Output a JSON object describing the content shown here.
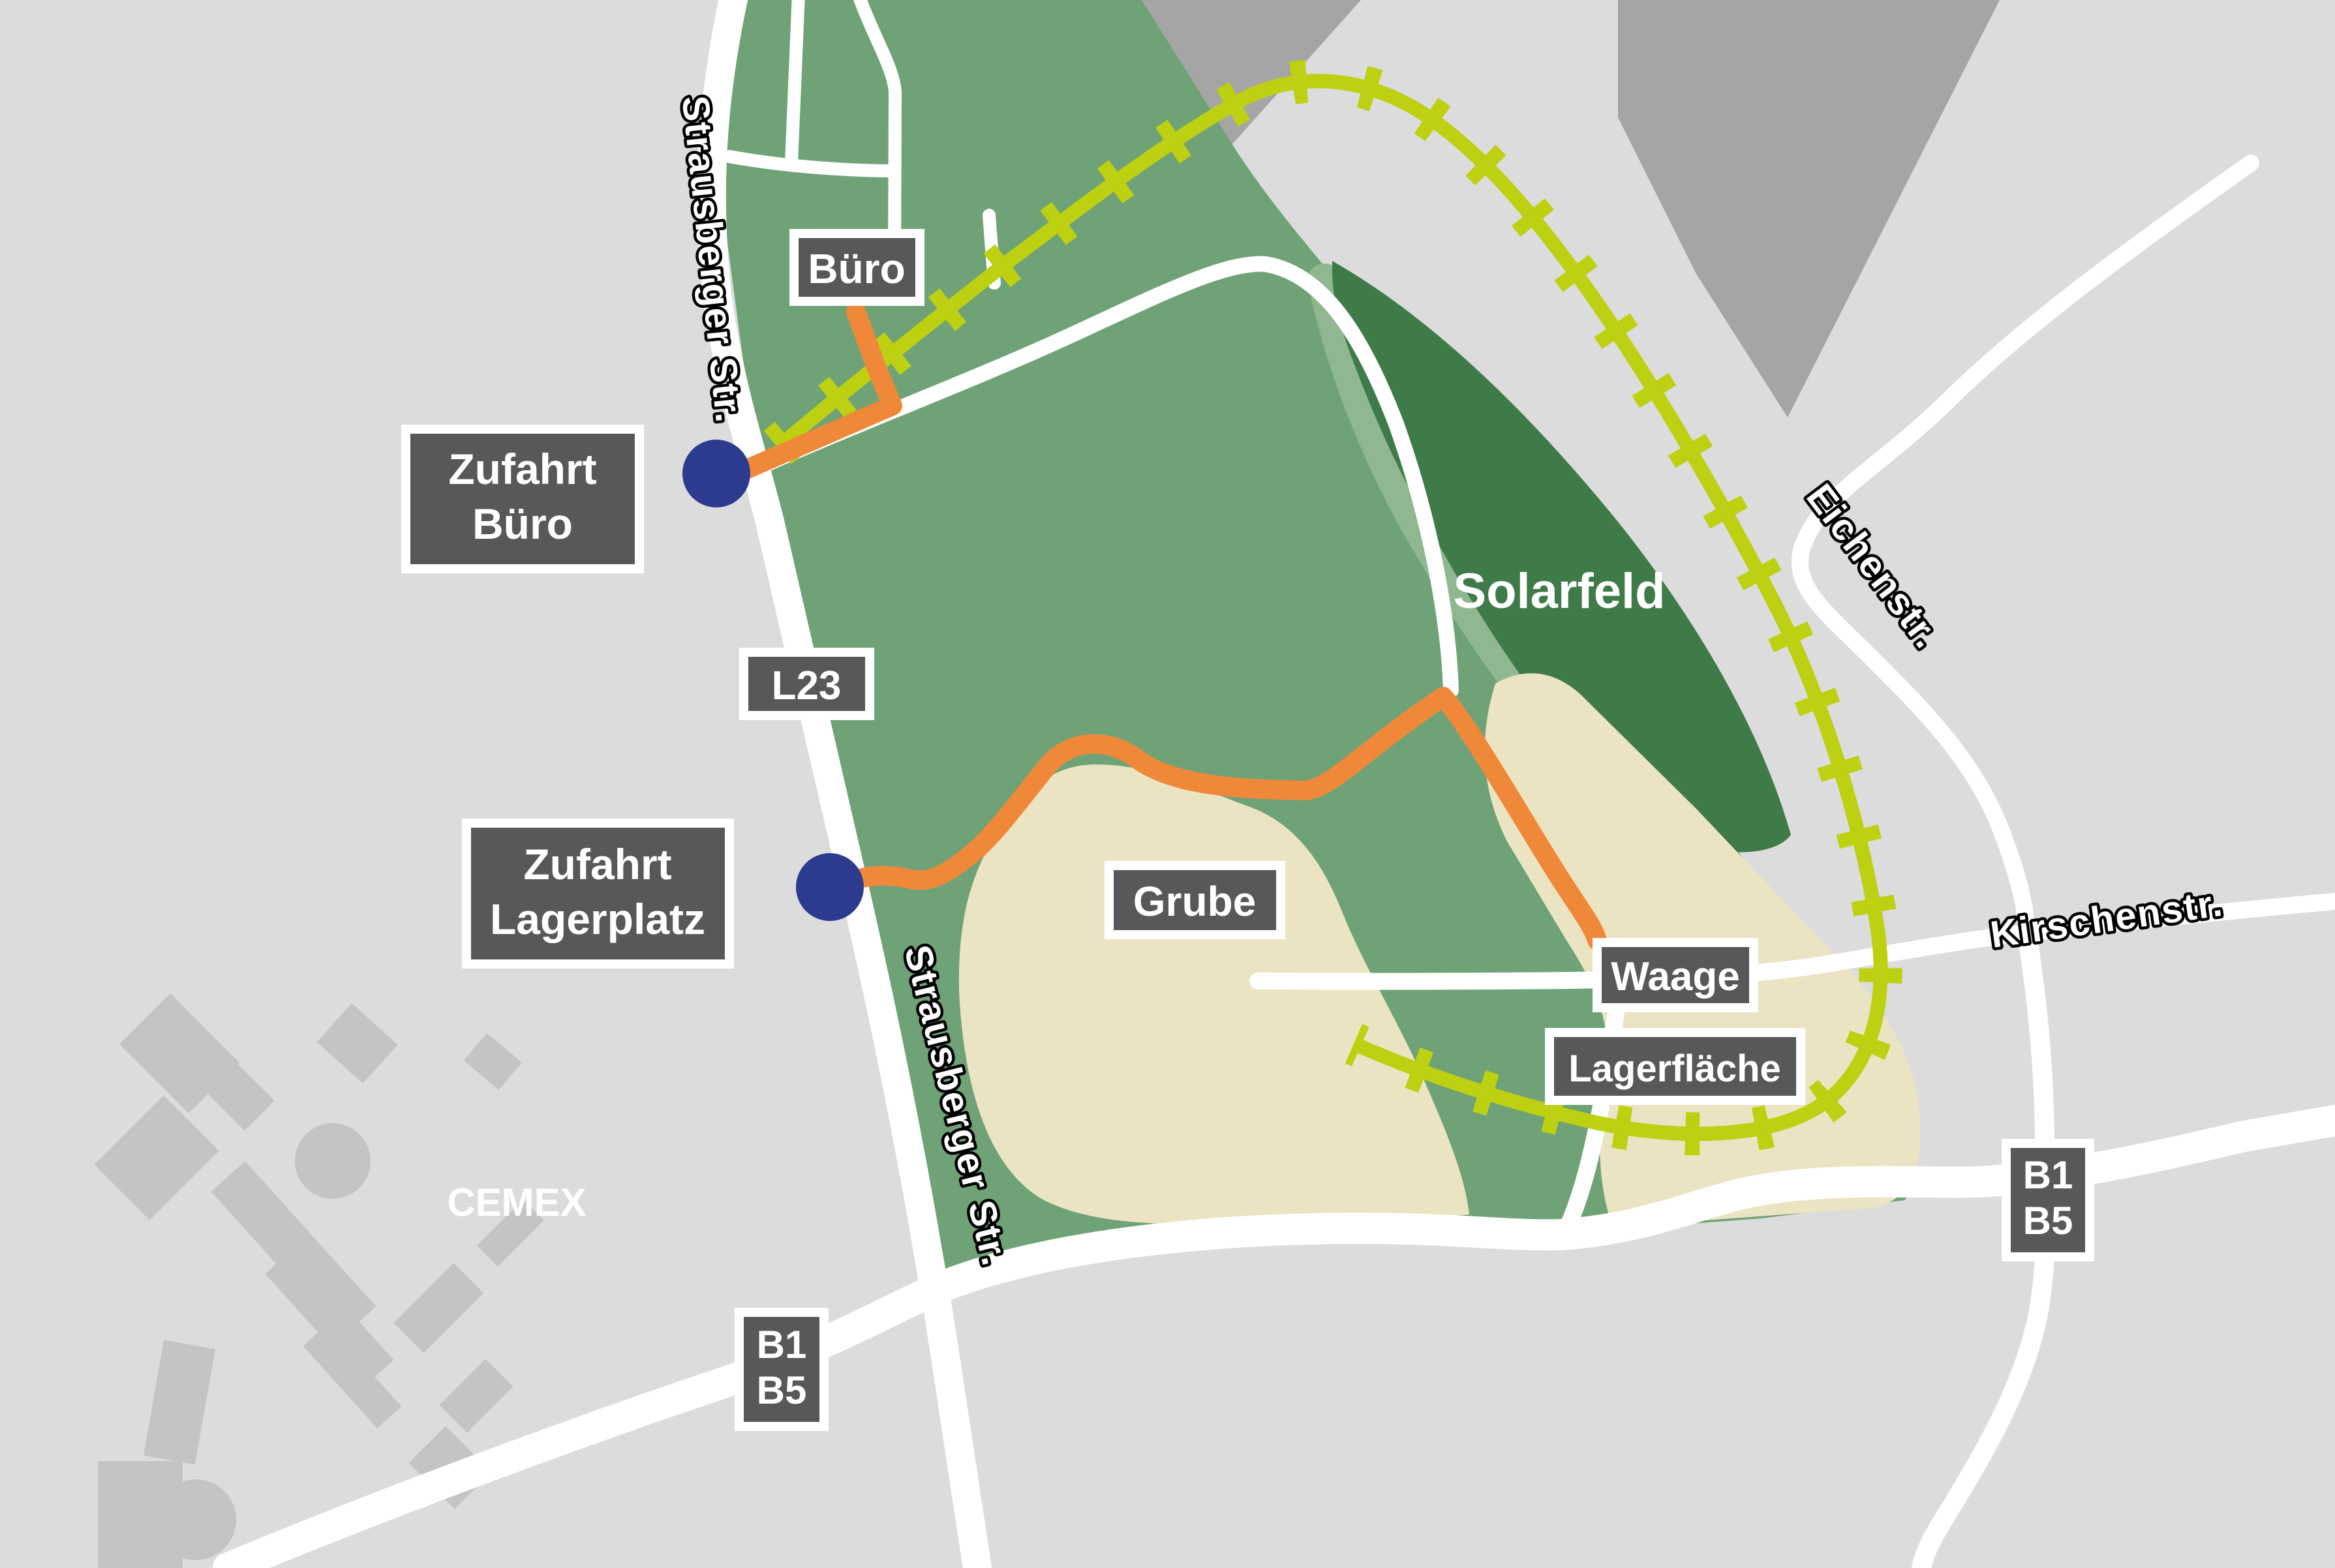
{
  "map": {
    "colors": {
      "bg_gray": "#dcdcdc",
      "block_gray": "#a5a5a5",
      "building_gray": "#c4c4c4",
      "site_green": "#6fa377",
      "band_green": "#8fb790",
      "solarfeld_green": "#3f7b49",
      "pit_beige": "#ebe4c3",
      "route_orange": "#f0883a",
      "rail_green": "#bdd012",
      "access_navy": "#2c3b8e",
      "box_gray": "#58585a",
      "road_white": "#ffffff"
    },
    "streets": {
      "strausberger": "Strausberger Str.",
      "eichenstr": "Eichenstr.",
      "kirschenstr": "Kirschenstr."
    },
    "areas": {
      "solarfeld": "Solarfeld",
      "cemex": "CEMEX"
    },
    "boxes": {
      "buero": {
        "label": "Büro"
      },
      "zufahrt_buero": {
        "line1": "Zufahrt",
        "line2": "Büro"
      },
      "zufahrt_lagerplatz": {
        "line1": "Zufahrt",
        "line2": "Lagerplatz"
      },
      "l23": {
        "label": "L23"
      },
      "grube": {
        "label": "Grube"
      },
      "waage": {
        "label": "Waage"
      },
      "lagerflaeche": {
        "label": "Lagerfläche"
      },
      "b1b5": {
        "line1": "B1",
        "line2": "B5"
      }
    }
  }
}
